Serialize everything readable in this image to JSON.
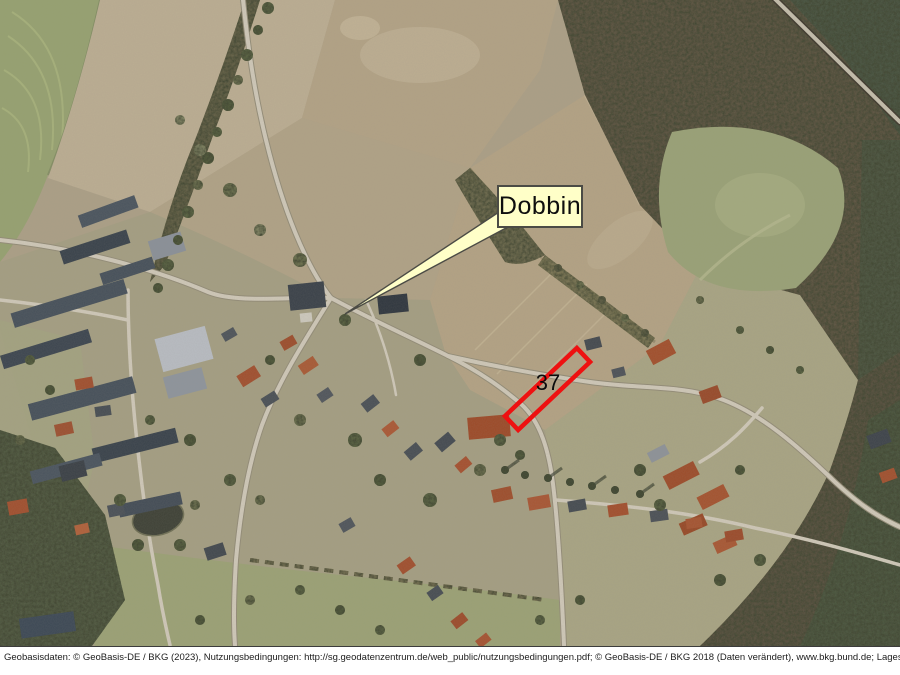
{
  "map": {
    "place_label": "Dobbin",
    "parcel": {
      "number": "37",
      "outline_color": "#ee1111"
    },
    "callout": {
      "fill_color": "#ffffc8",
      "border_color": "#4b4b45"
    }
  },
  "footer": {
    "attribution": "Geobasisdaten: © GeoBasis-DE / BKG (2023), Nutzungsbedingungen: http://sg.geodatenzentrum.de/web_public/nutzungsbedingungen.pdf; © GeoBasis-DE / BKG 2018 (Daten verändert), www.bkg.bund.de; Lageskizze"
  }
}
